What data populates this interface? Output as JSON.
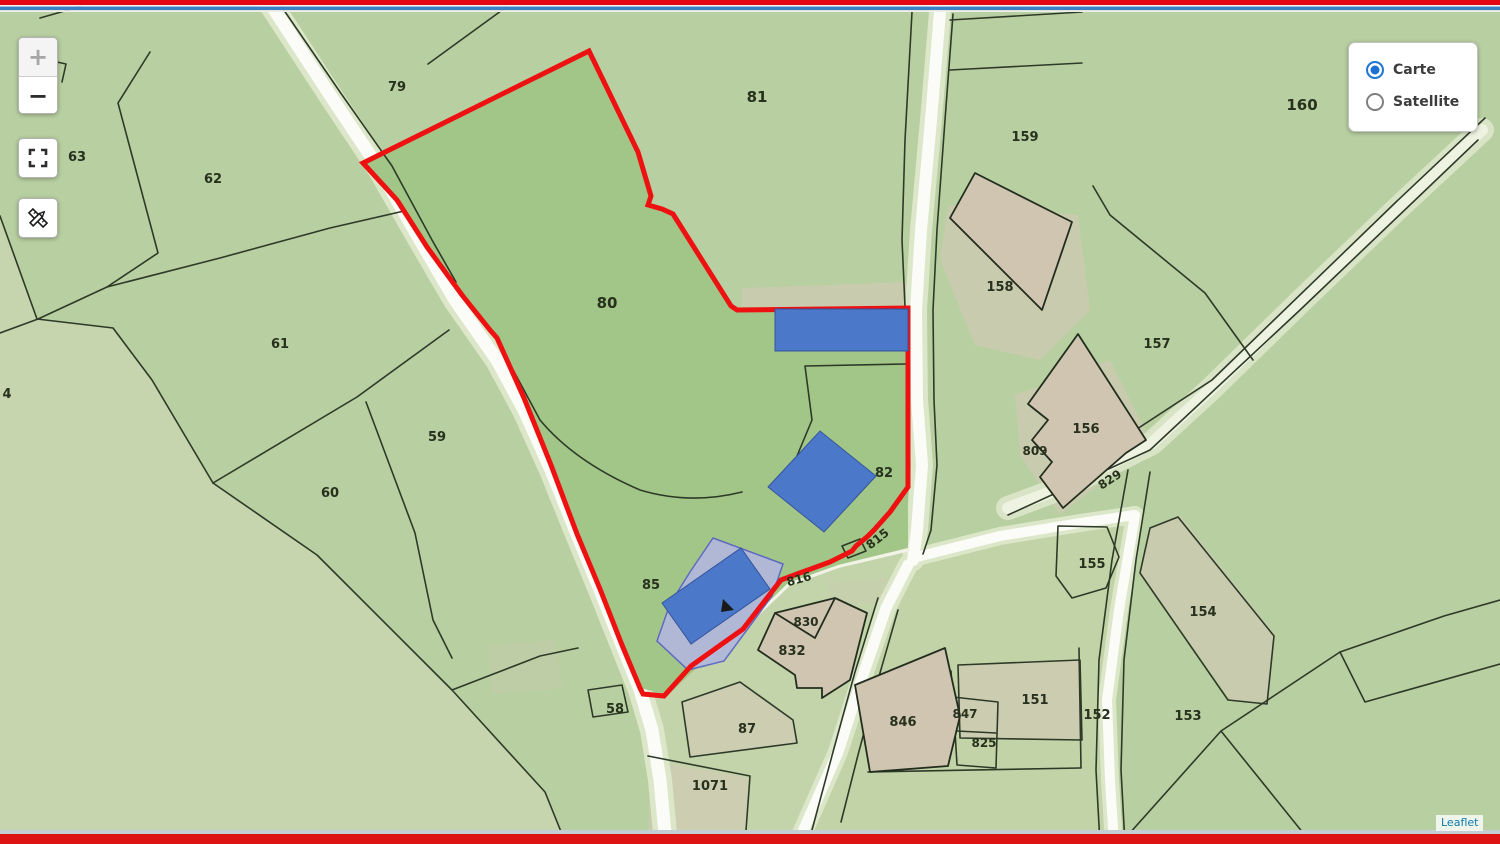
{
  "window": {
    "top_border_color": "#e30613",
    "accent_stripe_color": "#3c7fc4",
    "bottom_border_color": "#dd1212"
  },
  "map_controls": {
    "zoom_in_label": "+",
    "zoom_out_label": "−",
    "fullscreen_icon": "fullscreen-icon",
    "measure_icon": "measure-pencil-ruler-icon"
  },
  "layer_control": {
    "options": [
      {
        "label": "Carte",
        "selected": true
      },
      {
        "label": "Satellite",
        "selected": false
      }
    ]
  },
  "attribution": {
    "text": "Leaflet"
  },
  "map": {
    "selected_parcel_number": "80",
    "selected_outline_color": "#ee1111",
    "building_color": "#4b78c9",
    "highlight_parcel_color": "#b2b8da",
    "base_green": "#b8cfa1",
    "parcel_labels": [
      {
        "text": "79"
      },
      {
        "text": "81"
      },
      {
        "text": "63"
      },
      {
        "text": "62"
      },
      {
        "text": "4"
      },
      {
        "text": "61"
      },
      {
        "text": "59"
      },
      {
        "text": "60"
      },
      {
        "text": "80"
      },
      {
        "text": "82"
      },
      {
        "text": "85"
      },
      {
        "text": "58"
      },
      {
        "text": "87"
      },
      {
        "text": "1071"
      },
      {
        "text": "830"
      },
      {
        "text": "832"
      },
      {
        "text": "846"
      },
      {
        "text": "847"
      },
      {
        "text": "825"
      },
      {
        "text": "151"
      },
      {
        "text": "152"
      },
      {
        "text": "153"
      },
      {
        "text": "154"
      },
      {
        "text": "155"
      },
      {
        "text": "156"
      },
      {
        "text": "809"
      },
      {
        "text": "829"
      },
      {
        "text": "157"
      },
      {
        "text": "158"
      },
      {
        "text": "159"
      },
      {
        "text": "160"
      },
      {
        "text": "815"
      },
      {
        "text": "816"
      }
    ]
  }
}
